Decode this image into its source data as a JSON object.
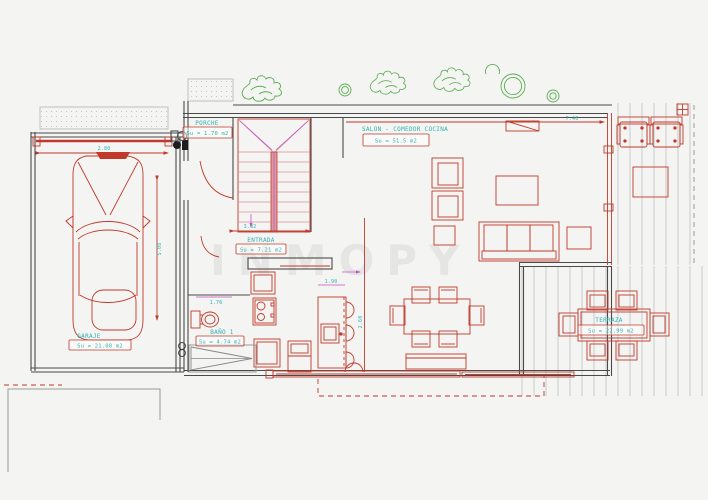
{
  "plan": {
    "watermark": "INMOPY",
    "rooms": {
      "porche": {
        "name": "PORCHE",
        "area": "Su = 1.70 m2"
      },
      "entrada": {
        "name": "ENTRADA",
        "area": "Su = 7.21 m2"
      },
      "salon": {
        "name": "SALON - COMEDOR COCINA",
        "area": "Su = 51.5 m2"
      },
      "bano": {
        "name": "BAÑO 1",
        "area": "Su = 4.74 m2"
      },
      "garaje": {
        "name": "GARAJE",
        "area": "Su = 21.08 m2"
      },
      "terraza": {
        "name": "TERRAZA",
        "area": "Su = 22.99 m2"
      }
    },
    "dimensions": {
      "garage_width": "2.80",
      "garage_depth": "5.08",
      "entry_width": "3.02",
      "salon_width": "7.40",
      "island_length": "1.90",
      "kitchen_depth": "2.60",
      "bath_width": "1.76"
    },
    "colors": {
      "wall": "#4a4a4a",
      "fixture_red": "#c0392b",
      "stair_pink": "#dc8f8f",
      "dim_magenta": "#c94fc9",
      "label_cyan": "#2fb3b3",
      "plant_green": "#5aad52",
      "deck_gray": "#c8cbce"
    }
  }
}
